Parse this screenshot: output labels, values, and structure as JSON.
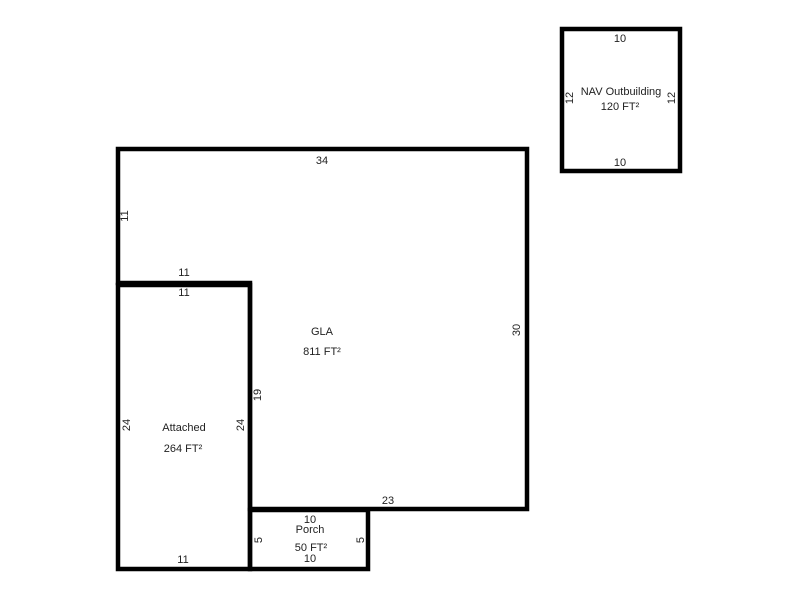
{
  "page": {
    "background_color": "#ffffff",
    "line_color": "#000000",
    "text_color": "#222222"
  },
  "sketch": {
    "canvas_width": 800,
    "canvas_height": 600,
    "stroke_width": 4.5,
    "areas": [
      {
        "id": "gla",
        "name": "GLA",
        "area": "811 FT²",
        "outline": [
          [
            118,
            149
          ],
          [
            527,
            149
          ],
          [
            527,
            509
          ],
          [
            250,
            509
          ],
          [
            250,
            283
          ],
          [
            118,
            283
          ]
        ],
        "name_pos": [
          322,
          335
        ],
        "area_pos": [
          322,
          355
        ],
        "dims": [
          {
            "text": "34",
            "x": 322,
            "y": 164,
            "rot": 0
          },
          {
            "text": "30",
            "x": 520,
            "y": 330,
            "rot": -90
          },
          {
            "text": "23",
            "x": 388,
            "y": 504,
            "rot": 0
          },
          {
            "text": "19",
            "x": 261,
            "y": 395,
            "rot": -90
          },
          {
            "text": "11",
            "x": 184,
            "y": 276,
            "rot": 0
          },
          {
            "text": "11",
            "x": 128,
            "y": 216,
            "rot": -90
          }
        ]
      },
      {
        "id": "attached",
        "name": "Attached",
        "area": "264 FT²",
        "outline": [
          [
            118,
            285
          ],
          [
            250,
            285
          ],
          [
            250,
            569
          ],
          [
            118,
            569
          ]
        ],
        "name_pos": [
          184,
          431
        ],
        "area_pos": [
          183,
          452
        ],
        "dims": [
          {
            "text": "11",
            "x": 184,
            "y": 296,
            "rot": 0
          },
          {
            "text": "24",
            "x": 130,
            "y": 425,
            "rot": -90
          },
          {
            "text": "24",
            "x": 244,
            "y": 425,
            "rot": -90
          },
          {
            "text": "11",
            "x": 183,
            "y": 563,
            "rot": 0
          }
        ]
      },
      {
        "id": "porch",
        "name": "Porch",
        "area": "50 FT²",
        "outline": [
          [
            250,
            510
          ],
          [
            368,
            510
          ],
          [
            368,
            569
          ],
          [
            250,
            569
          ]
        ],
        "name_pos": [
          310,
          533
        ],
        "area_pos": [
          311,
          551
        ],
        "dims": [
          {
            "text": "10",
            "x": 310,
            "y": 523,
            "rot": 0
          },
          {
            "text": "5",
            "x": 262,
            "y": 540,
            "rot": -90
          },
          {
            "text": "5",
            "x": 364,
            "y": 540,
            "rot": -90
          },
          {
            "text": "10",
            "x": 310,
            "y": 562,
            "rot": 0
          }
        ]
      },
      {
        "id": "nav-outbuilding",
        "name": "NAV Outbuilding",
        "area": "120 FT²",
        "outline": [
          [
            562,
            29
          ],
          [
            680,
            29
          ],
          [
            680,
            171
          ],
          [
            562,
            171
          ]
        ],
        "name_pos": [
          621,
          95
        ],
        "area_pos": [
          620,
          110
        ],
        "dims": [
          {
            "text": "10",
            "x": 620,
            "y": 42,
            "rot": 0
          },
          {
            "text": "12",
            "x": 573,
            "y": 98,
            "rot": -90
          },
          {
            "text": "12",
            "x": 675,
            "y": 98,
            "rot": -90
          },
          {
            "text": "10",
            "x": 620,
            "y": 166,
            "rot": 0
          }
        ]
      }
    ]
  }
}
